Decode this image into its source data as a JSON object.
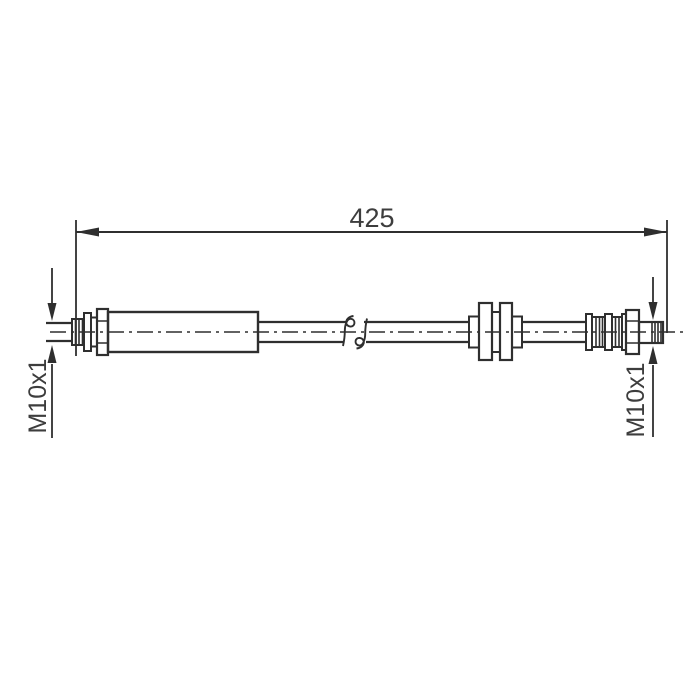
{
  "drawing": {
    "type": "brake-hose-technical-drawing",
    "dimension_label": "425",
    "left_thread_label": "M10x1",
    "right_thread_label": "M10x1",
    "colors": {
      "line": "#2f2f2f",
      "text": "#3d3d3d",
      "background": "#ffffff"
    }
  }
}
